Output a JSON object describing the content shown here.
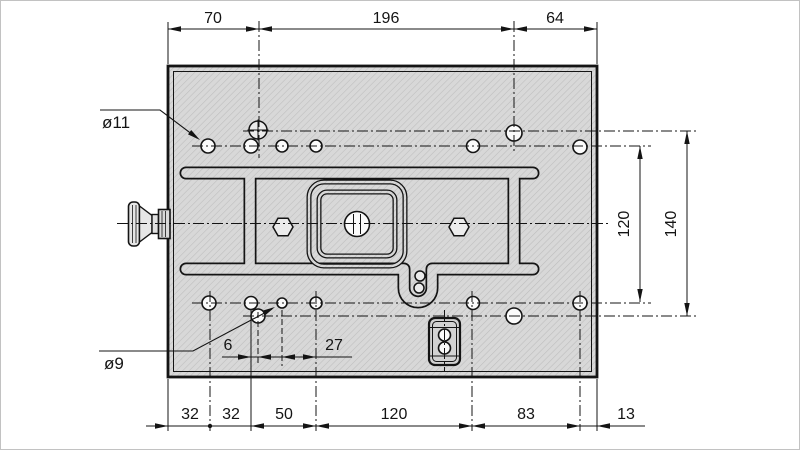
{
  "drawing": {
    "type": "technical-drawing-mounting-plate",
    "top_dims": [
      "70",
      "196",
      "64"
    ],
    "bottom_dims": [
      "32",
      "32",
      "50",
      "120",
      "83",
      "13"
    ],
    "right_dims": [
      "120",
      "140"
    ],
    "detail_dims": [
      "6",
      "27"
    ],
    "hole_callouts": [
      "ø11",
      "ø9"
    ],
    "colors": {
      "plate_fill": "#d8d8d8",
      "hatch_line": "#bdbdbd",
      "line": "#141414",
      "background": "#ffffff"
    }
  }
}
